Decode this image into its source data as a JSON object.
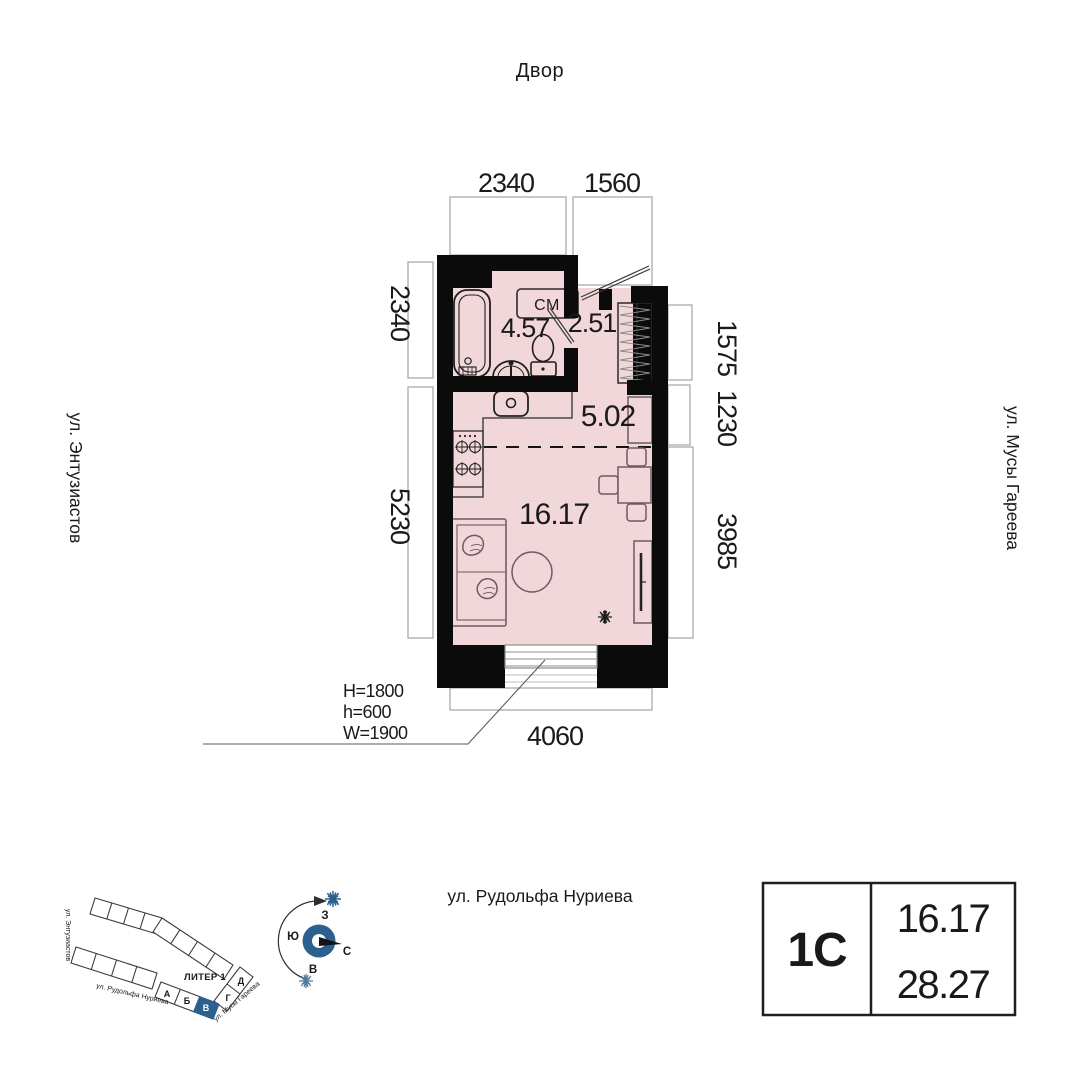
{
  "colors": {
    "accent_blue": "#2b608f",
    "accent_blue_light": "#51799c",
    "room_fill": "#f2d7da",
    "wall": "#0b0b0b"
  },
  "plan": {
    "courtyard_label": "Двор",
    "washing_machine_label": "СМ",
    "rooms": {
      "bathroom": "4.57",
      "hallway": "2.51",
      "kitchen": "5.02",
      "living": "16.17"
    },
    "dimensions": {
      "top": [
        "2340",
        "1560"
      ],
      "left": [
        "2340",
        "5230"
      ],
      "right": [
        "1575",
        "1230",
        "3985"
      ],
      "bottom": "4060"
    },
    "window_specs": [
      "H=1800",
      "h=600",
      "W=1900"
    ],
    "streets": {
      "left": "ул. Энтузиастов",
      "right": "ул. Мусы Гареева",
      "bottom": "ул. Рудольфа Нуриева"
    }
  },
  "site_plan": {
    "liter_label": "ЛИТЕР 1",
    "blocks": [
      "А",
      "Б",
      "В",
      "Г",
      "Д"
    ],
    "highlighted_block": "В",
    "streets": {
      "enthusiasts": "ул. Энтузиастов",
      "rudolf": "ул. Рудольфа Нуриева",
      "musa": "ул. Мусы Гареева"
    }
  },
  "compass": {
    "west": "З",
    "south": "Ю",
    "north": "С",
    "east": "В"
  },
  "info_box": {
    "unit_type": "1С",
    "living_area": "16.17",
    "total_area": "28.27"
  }
}
